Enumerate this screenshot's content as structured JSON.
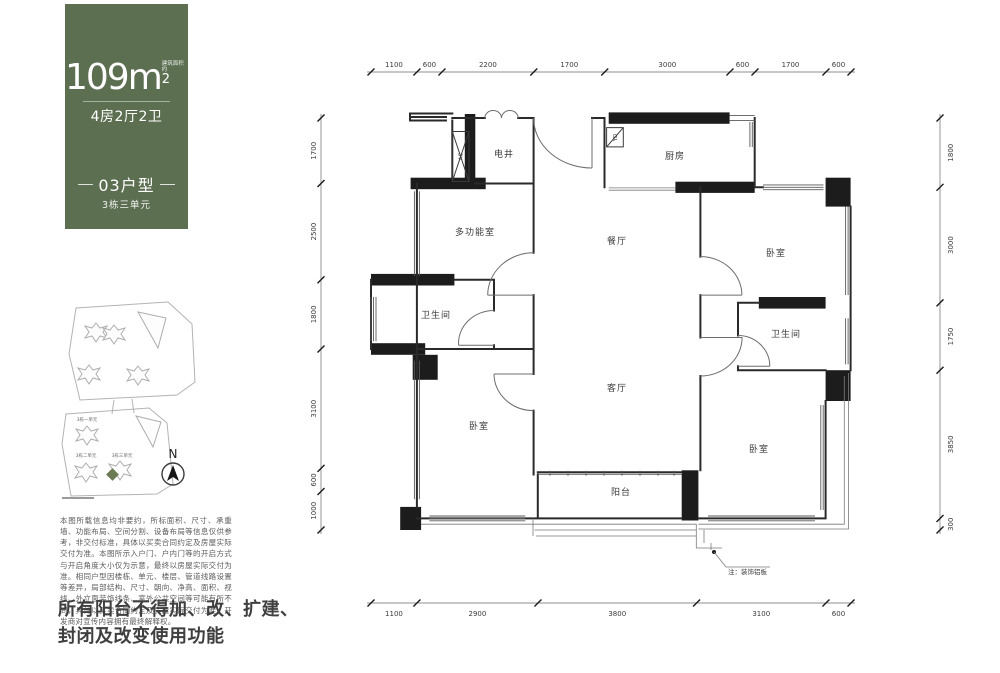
{
  "panel": {
    "bg_color": "#5c6f51",
    "highlight_color": "#6b7a54",
    "area_value": "109",
    "area_unit": "m",
    "area_sup": "2",
    "area_note": "建筑面积约",
    "layout_badge": "4房2厅2卫",
    "unit_type": "03户型",
    "unit_sub": "3栋三单元",
    "siteplan": {
      "buildings": [
        "3栋一单元",
        "3栋二单元",
        "3栋三单元"
      ],
      "north_label": "N"
    },
    "disclaimer": "本图所载信息均非要约，所标面积、尺寸、承重墙、功能布局、空间分割、设备布局等信息仅供参考，非交付标准，具体以买卖合同约定及房屋实际交付为准。本图所示入户门、户内门等的开启方式与开启角度大小仅为示意，最终以房屋实际交付为准。相同户型因楼栋、单元、楼层、管道线路设置等差异，局部结构、尺寸、朝向、净高、面积、视线、外立面装饰线条、室外公共空间等可能有所不同，具体以买卖合同约定及房屋实际交付为准。开发商对宣传内容拥有最终解释权。",
    "notice_line1": "所有阳台不得加、改、扩建、",
    "notice_line2": "封闭及改变使用功能"
  },
  "plan": {
    "rooms": [
      {
        "id": "shaft",
        "label": "电井"
      },
      {
        "id": "kitchen",
        "label": "厨房"
      },
      {
        "id": "multifunction",
        "label": "多功能室"
      },
      {
        "id": "dining",
        "label": "餐厅"
      },
      {
        "id": "bedroom-ne",
        "label": "卧室"
      },
      {
        "id": "bath-west",
        "label": "卫生间"
      },
      {
        "id": "living",
        "label": "客厅"
      },
      {
        "id": "bath-east",
        "label": "卫生间"
      },
      {
        "id": "bedroom-sw",
        "label": "卧室"
      },
      {
        "id": "bedroom-se",
        "label": "卧室"
      },
      {
        "id": "balcony",
        "label": "阳台"
      }
    ],
    "labels": {
      "ac": "AC",
      "yd": "YD",
      "note": "注：装饰铝板"
    },
    "dimensions": {
      "top": [
        1100,
        600,
        2200,
        1700,
        3000,
        600,
        1700,
        600
      ],
      "bottom": [
        1100,
        2900,
        3800,
        3100,
        600
      ],
      "left": [
        1700,
        2500,
        1800,
        3100,
        600,
        1000
      ],
      "right": [
        1800,
        3000,
        1750,
        3850,
        300
      ]
    }
  }
}
